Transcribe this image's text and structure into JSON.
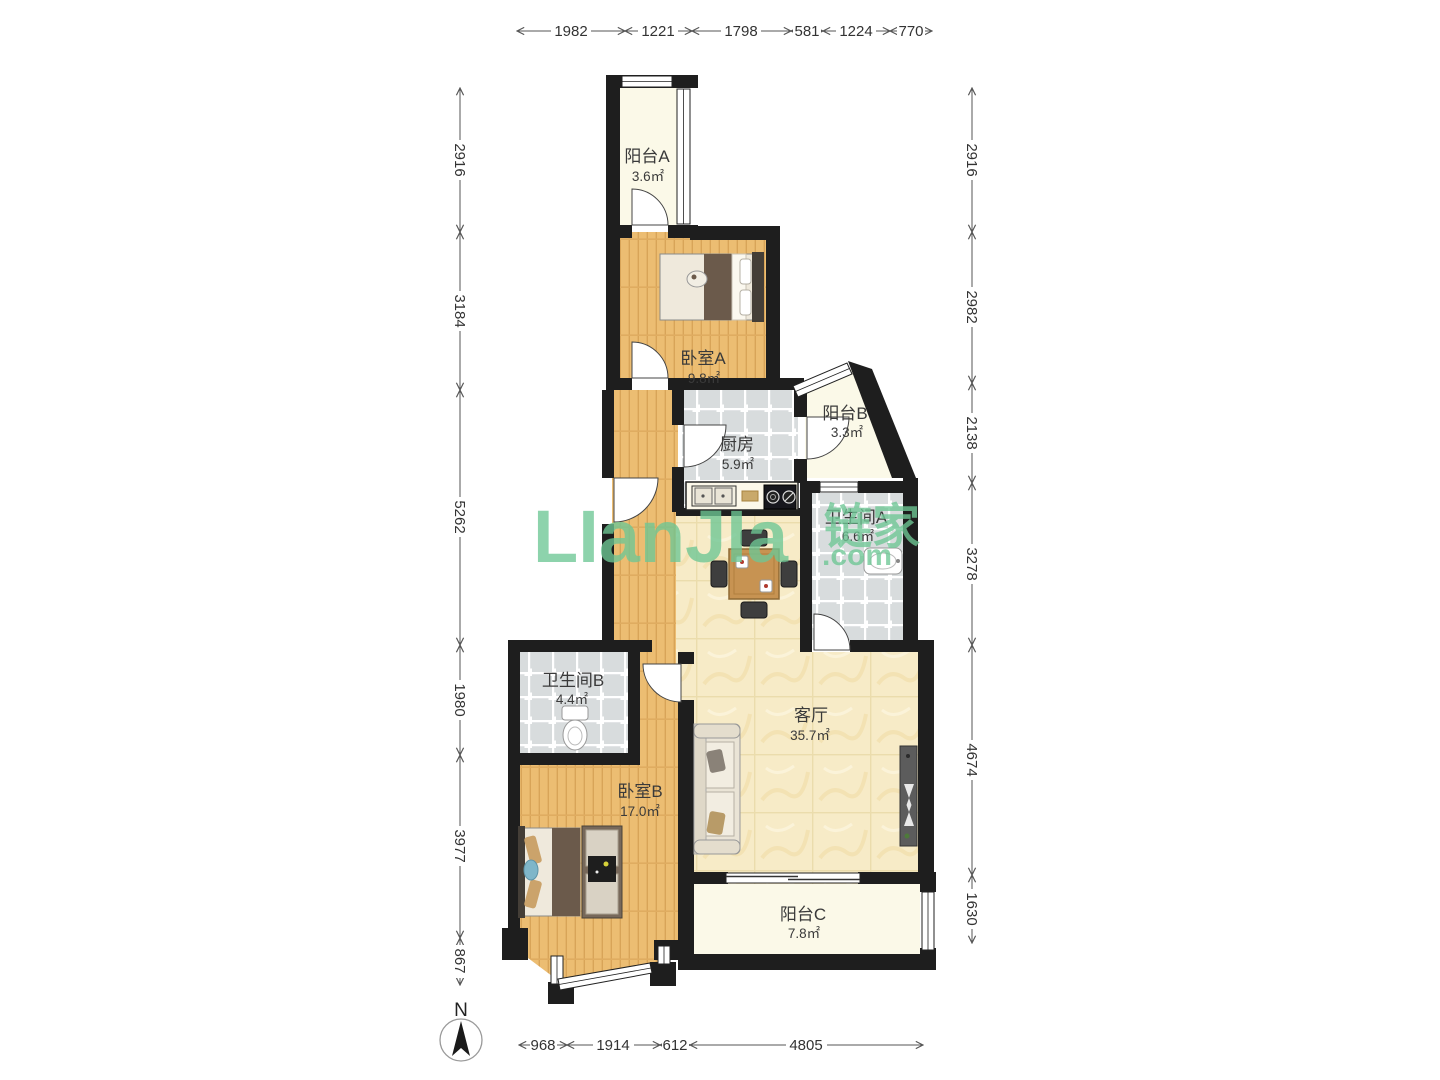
{
  "rooms": [
    {
      "name": "阳台A",
      "area": "3.6㎡"
    },
    {
      "name": "卧室A",
      "area": "9.8㎡"
    },
    {
      "name": "厨房",
      "area": "5.9㎡"
    },
    {
      "name": "阳台B",
      "area": "3.3㎡"
    },
    {
      "name": "卫生间A",
      "area": "6.6㎡"
    },
    {
      "name": "卫生间B",
      "area": "4.4㎡"
    },
    {
      "name": "客厅",
      "area": "35.7㎡"
    },
    {
      "name": "卧室B",
      "area": "17.0㎡"
    },
    {
      "name": "阳台C",
      "area": "7.8㎡"
    }
  ],
  "dimensions": {
    "top": [
      "1982",
      "1221",
      "1798",
      "581",
      "1224",
      "770"
    ],
    "left": [
      "2916",
      "3184",
      "5262",
      "1980",
      "3977",
      "867"
    ],
    "right": [
      "2916",
      "2982",
      "2138",
      "3278",
      "4674",
      "1630"
    ],
    "bottom": [
      "968",
      "1914",
      "612",
      "4805"
    ]
  },
  "watermark": {
    "latin": "LIanJIa",
    "cjk": "链家",
    "com": ".com",
    "color": "#6EC795"
  },
  "compass": {
    "label": "N"
  }
}
